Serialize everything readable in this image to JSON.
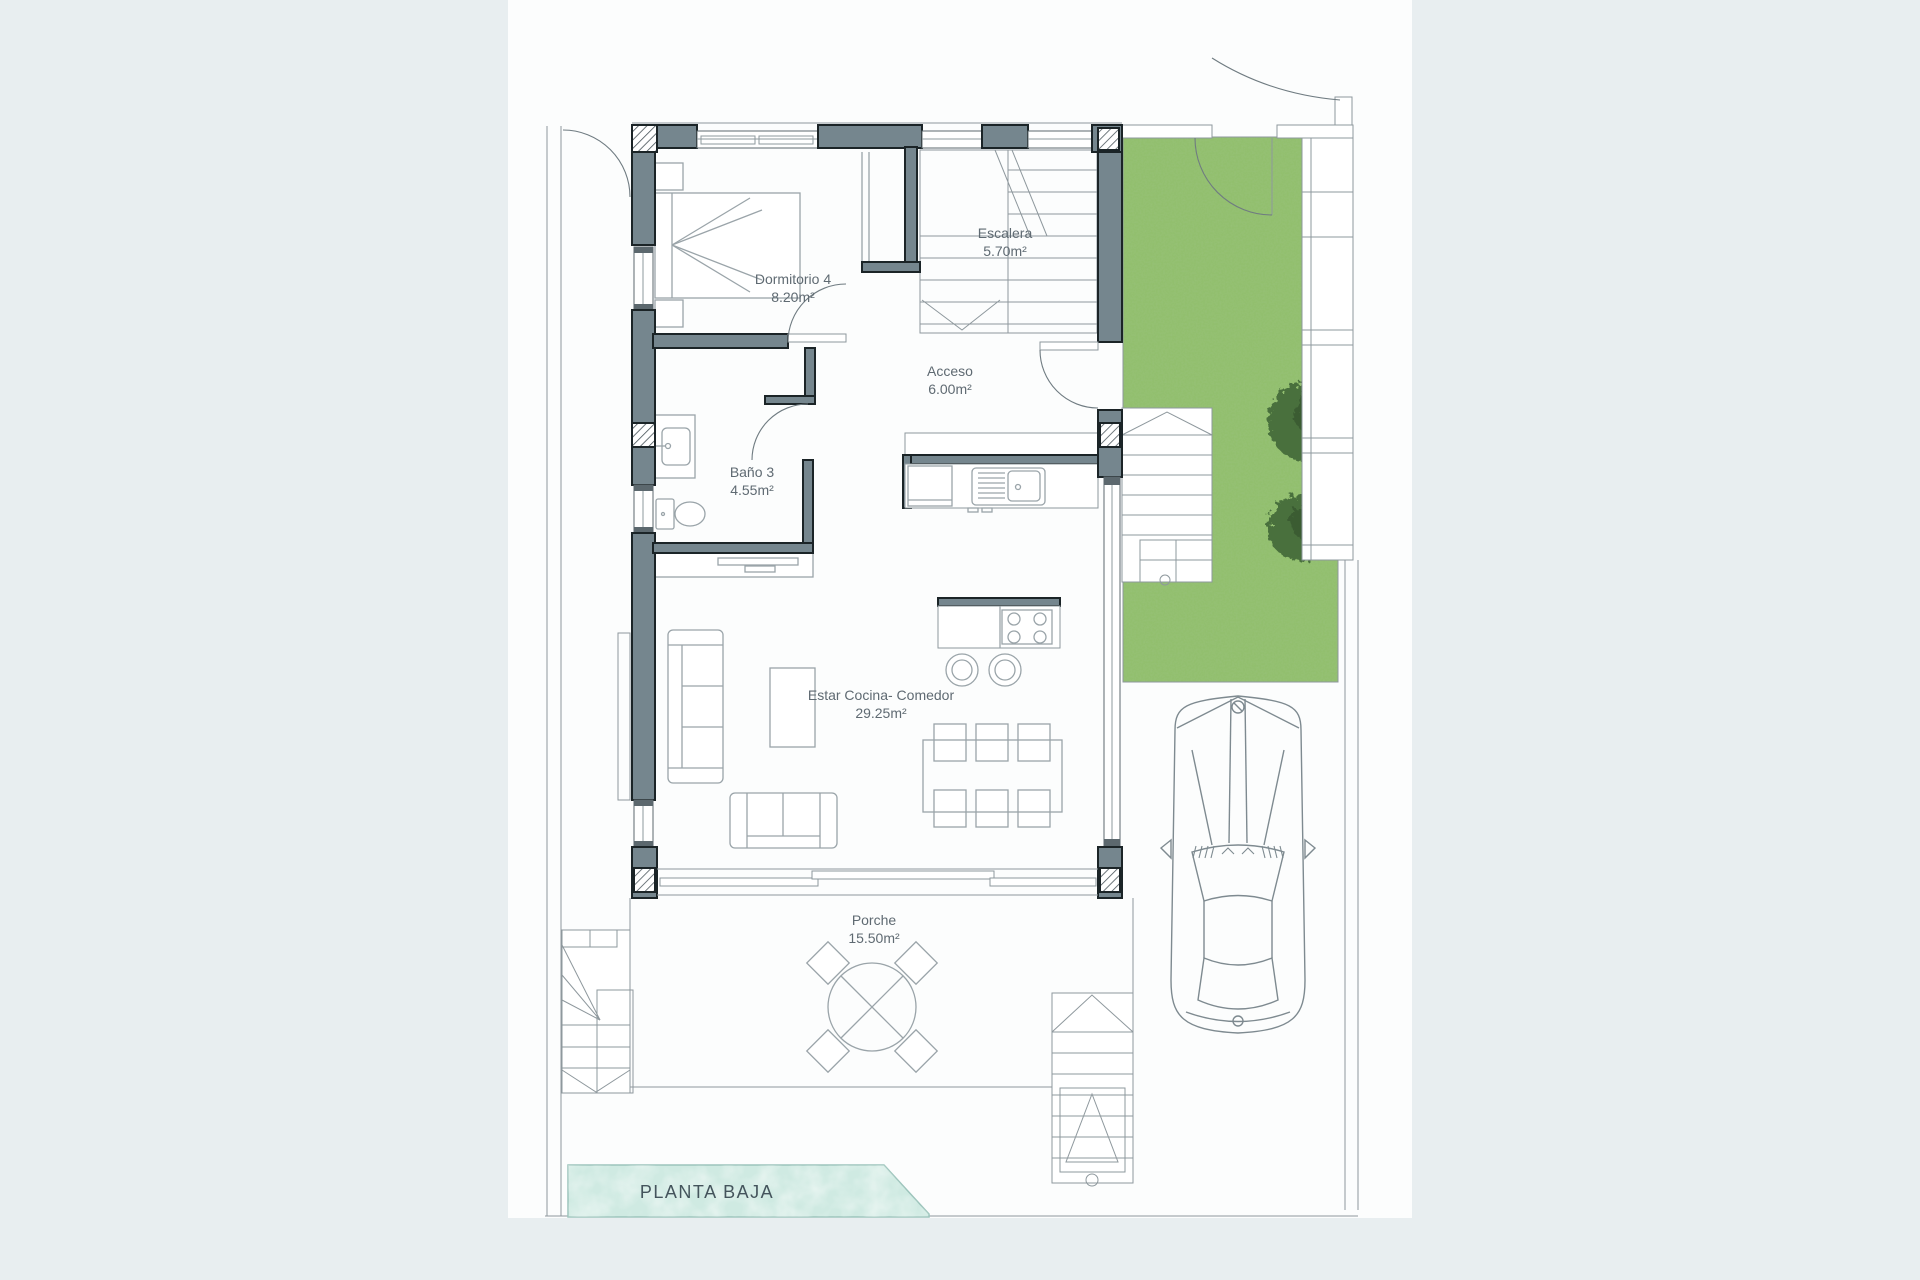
{
  "title": "PLANTA BAJA",
  "plan": {
    "rooms": [
      {
        "name": "Dormitorio 4",
        "area": "8.20m²"
      },
      {
        "name": "Escalera",
        "area": "5.70m²"
      },
      {
        "name": "Acceso",
        "area": "6.00m²"
      },
      {
        "name": "Baño 3",
        "area": "4.55m²"
      },
      {
        "name": "Estar Cocina- Comedor",
        "area": "29.25m²"
      },
      {
        "name": "Porche",
        "area": "15.50m²"
      }
    ]
  },
  "colors": {
    "bg": "#e8eef0",
    "page": "#fcfdfd",
    "wall": "#75868e",
    "wallline": "#1b2427",
    "grass": "#92bf6e",
    "grassdark": "#679b4a",
    "tree": "#49703c",
    "treedark": "#3a5c33",
    "pool": "#cfeae2",
    "pooledge": "#9cc4bb",
    "thin": "#8e989d",
    "furn": "#9aa4a9",
    "text": "#5f6a72",
    "title": "#44545c"
  }
}
